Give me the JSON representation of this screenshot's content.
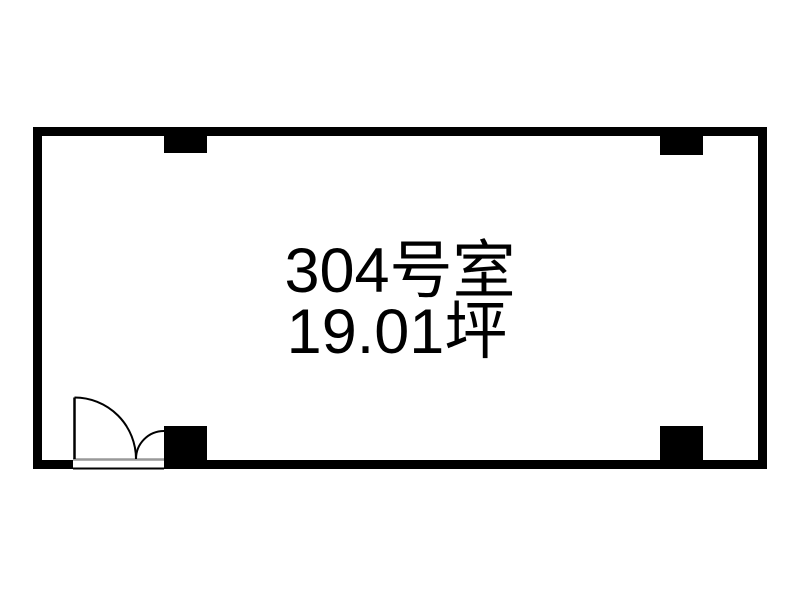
{
  "floorplan": {
    "room_label": "304号室",
    "area_label": "19.01坪",
    "colors": {
      "wall": "#000000",
      "background": "#ffffff",
      "threshold": "#999999",
      "text": "#000000"
    }
  }
}
